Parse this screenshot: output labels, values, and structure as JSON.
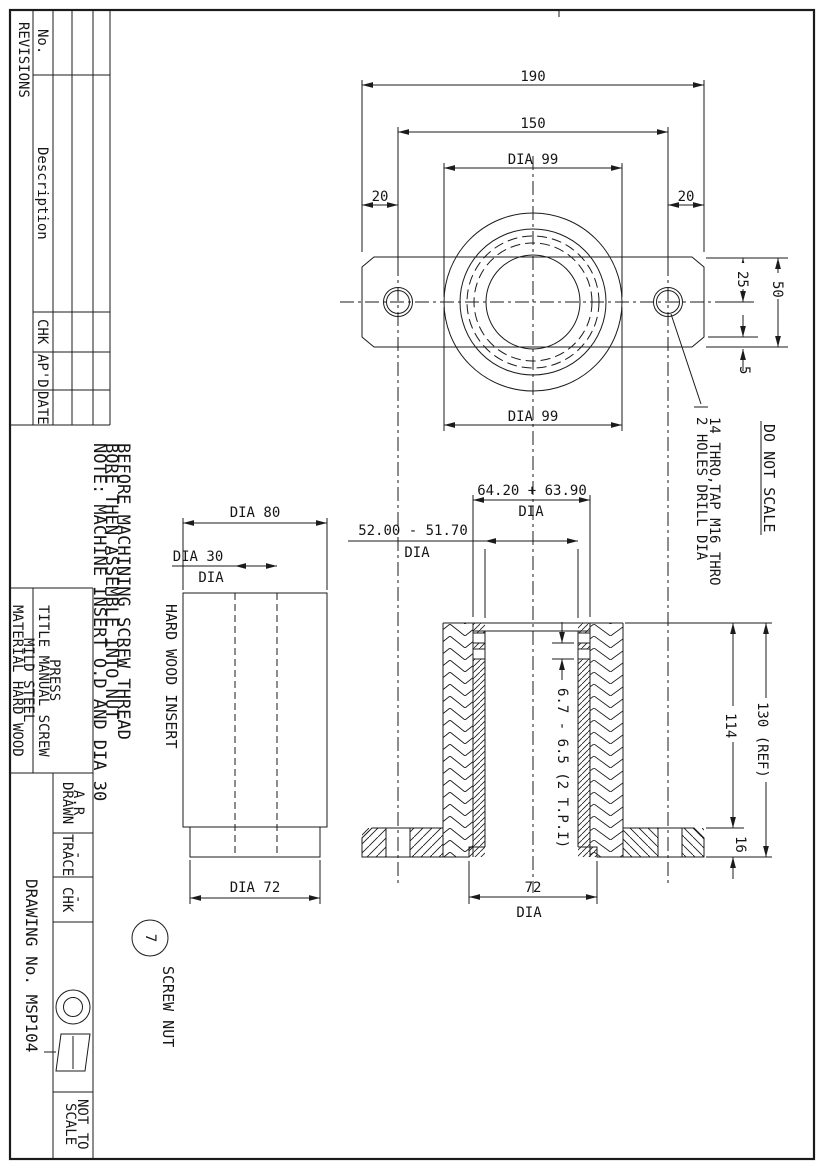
{
  "sheet": {
    "do_not_scale": "DO NOT SCALE"
  },
  "revisions_table": {
    "title": "REVISIONS",
    "col_no": "No.",
    "col_description": "Description",
    "col_chk": "CHK",
    "col_apd": "AP'D",
    "col_date": "DATE"
  },
  "notes": {
    "line1": "NOTE: MACHINE INSERT O.D AND DIA 30",
    "line2": "BORE THEN ASSEMBLE INTO NUT",
    "line3": "BEFORE MACHINING SCREW THREAD"
  },
  "title_block": {
    "title_line1": "TITLE MANUAL SCREW",
    "title_line2": "PRESS",
    "material_line1": "MATERIAL HARD WOOD",
    "material_line2": "MILD STEEL",
    "drawn_label": "DRAWN",
    "drawn_value": "A.R",
    "trace_label": "TRACE",
    "trace_value": "-",
    "chk_label": "CHK",
    "chk_value": "-",
    "drawing_no": "DRAWING No. MSP104",
    "scale_line1": "NOT TO",
    "scale_line2": "SCALE"
  },
  "plan_view": {
    "dim_overall_width": "190",
    "dim_hole_centres": "150",
    "dim_boss_dia_top": "DIA 99",
    "dim_boss_dia_bottom": "DIA 99",
    "dim_left_margin": "20",
    "dim_right_margin": "20",
    "dim_hole_offset": "25",
    "dim_plate_height": "50",
    "dim_chamfer": "5",
    "holes_note_line1": "2 HOLES DRILL DIA",
    "holes_note_line2": "14 THRO,TAP M16 THRO"
  },
  "section_view": {
    "dim_thread_major": "64.20 + 63.90",
    "dim_thread_major_suffix": "DIA",
    "dim_bore": "52.00 - 51.70",
    "dim_bore_suffix": "DIA",
    "dim_pitch": "6.7 - 6.5 (2 T.P.I)",
    "dim_body_height": "114",
    "dim_overall_height": "130 (REF)",
    "dim_flange_thickness": "16",
    "dim_counterbore": "72",
    "dim_counterbore_suffix": "DIA"
  },
  "insert_view": {
    "label": "HARD WOOD INSERT",
    "dim_od": "DIA 80",
    "dim_bore": "DIA 30",
    "dim_bore_suffix": "DIA",
    "dim_spigot": "DIA 72"
  },
  "callout": {
    "balloon_number": "7",
    "part_name": "SCREW NUT"
  }
}
